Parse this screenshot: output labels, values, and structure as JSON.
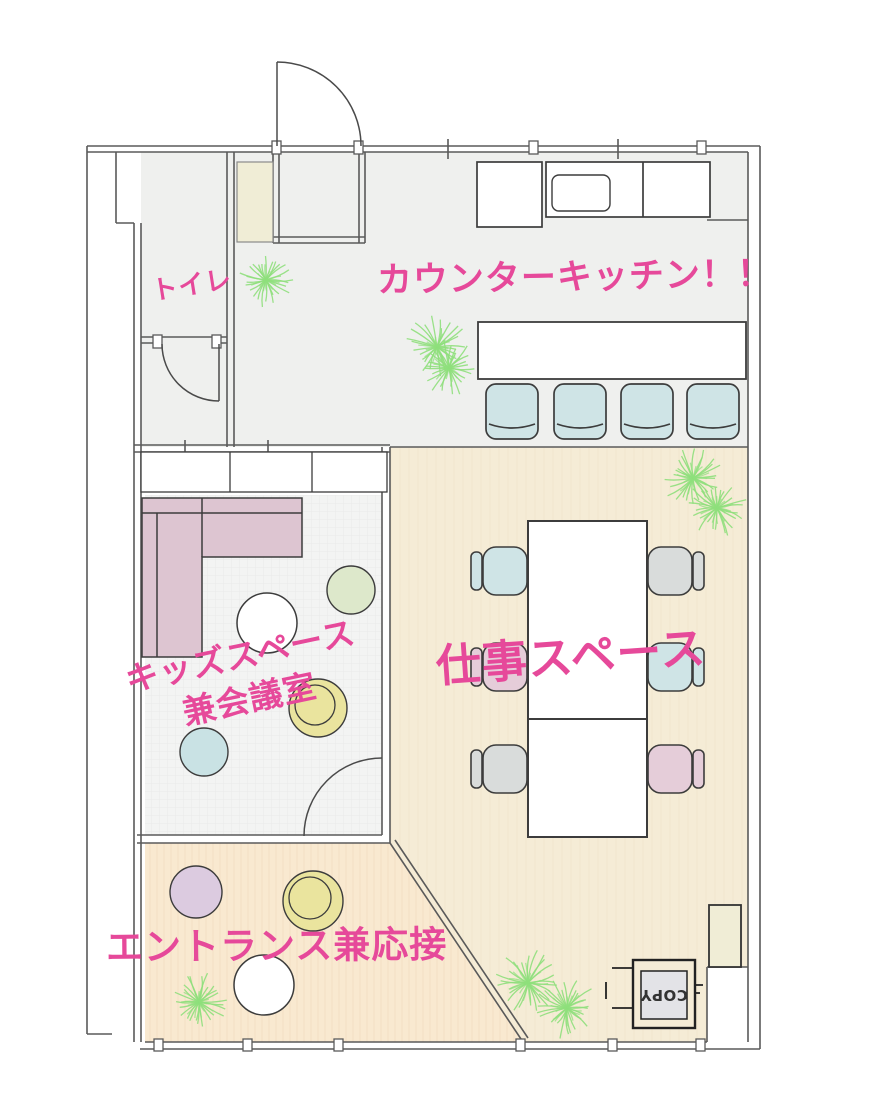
{
  "rooms": {
    "kitchen": {
      "label": "カウンターキッチン！！"
    },
    "toilet": {
      "label": "トイレ"
    },
    "kids": {
      "label_line1": "キッズスペース",
      "label_line2": "兼会議室"
    },
    "work": {
      "label": "仕事スペース"
    },
    "entrance": {
      "label": "エントランス兼応接"
    }
  },
  "equipment": {
    "copier_label": "COPY"
  },
  "colors": {
    "label_pink": "#e6499a",
    "wall_gray": "#5a5a5a",
    "line_dark": "#3c3c3c",
    "floor_hall": "#eff0ee",
    "floor_work": "#f5ecd6",
    "floor_entrance": "#f9e9d0",
    "floor_kids": "#f3f4f3",
    "closet_cream": "#f0edd6",
    "sofa_pink": "#ddc5d1",
    "chair_blue": "#cfe4e6",
    "chair_gray": "#d9dcdb",
    "chair_pink": "#e5cdd9",
    "circle_green": "#dde8cb",
    "circle_yellow": "#eae49e",
    "circle_blue": "#c9e2e4",
    "circle_purple": "#dccbe0",
    "copier_inner": "#e3e3e7",
    "plant_green": "#8fdf7c"
  }
}
